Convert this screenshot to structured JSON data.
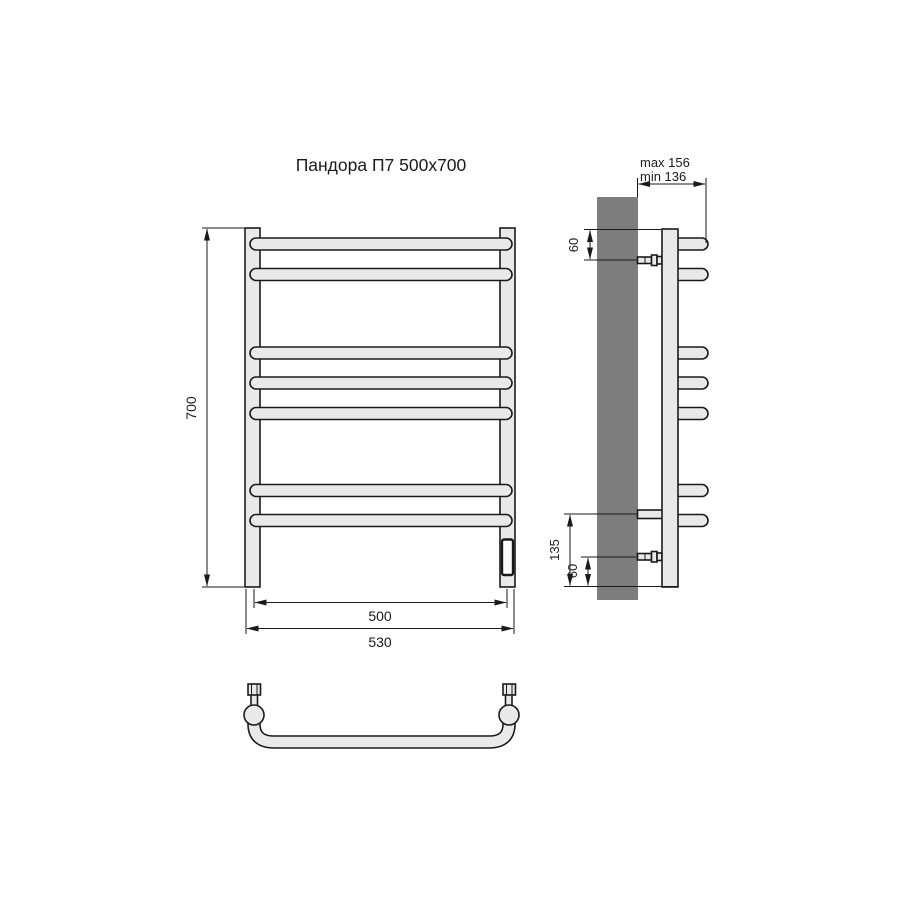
{
  "title": "Пандора П7 500x700",
  "views": {
    "front": {
      "name": "front-view",
      "bar_count": 7,
      "dimensions": {
        "height": "700",
        "axis_width": "500",
        "overall_width": "530"
      }
    },
    "side": {
      "name": "side-view",
      "dimensions": {
        "depth_max": "max 156",
        "depth_min": "min 136",
        "top_offset": "60",
        "bottom_span": "135",
        "bottom_offset": "60"
      }
    },
    "top": {
      "name": "top-view"
    }
  },
  "colors": {
    "line": "#1a1a1a",
    "fill_light": "#e9e9e9",
    "fill_wall": "#7d7d7d",
    "background": "#ffffff"
  }
}
